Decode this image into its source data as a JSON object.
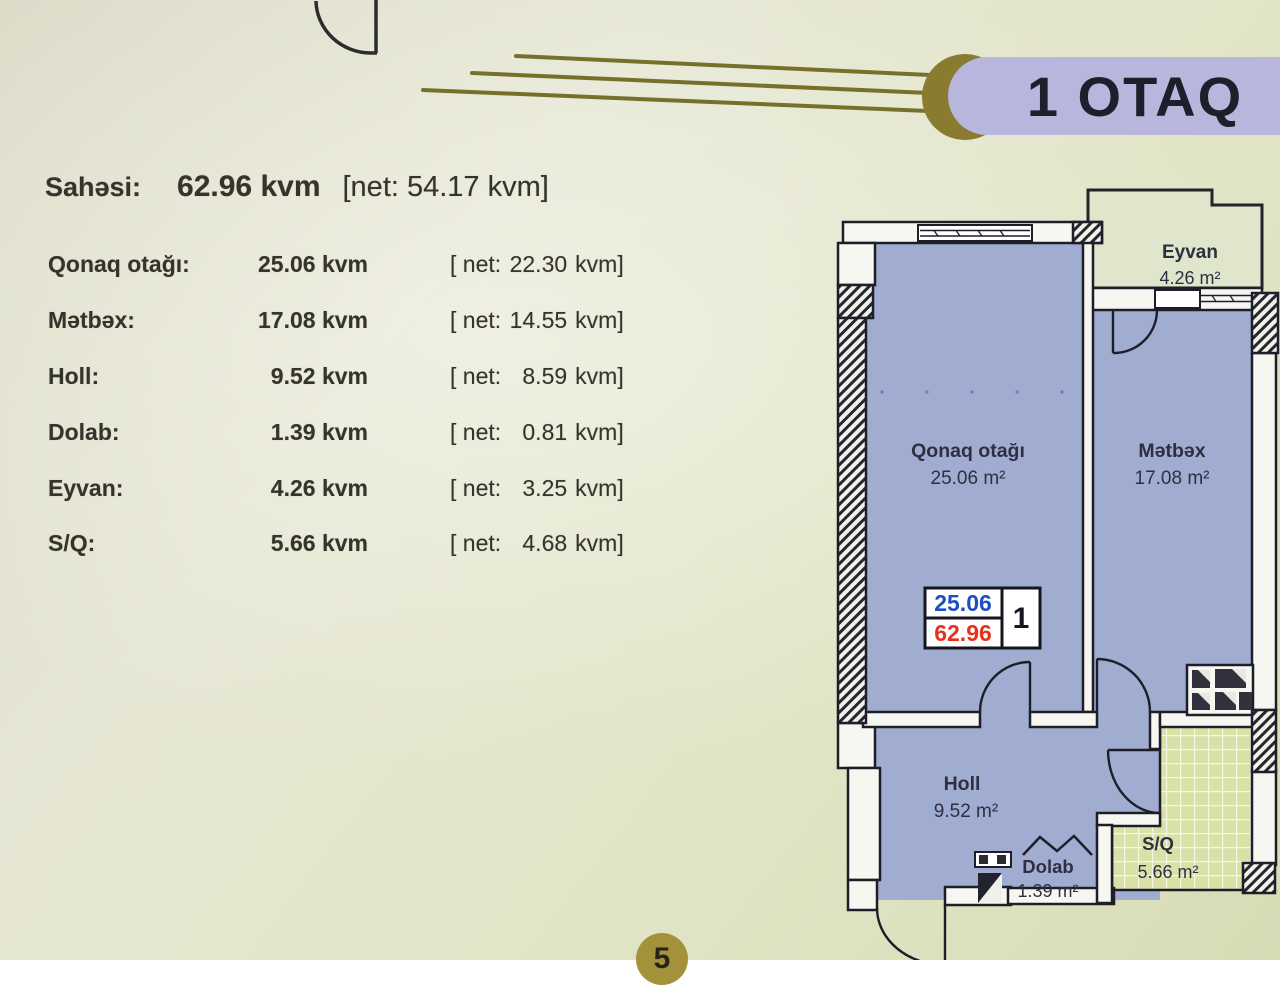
{
  "header": {
    "pill_label": "1 OTAQ"
  },
  "summary": {
    "label": "Sahəsi:",
    "total_value": "62.96 kvm",
    "net_value": "[net: 54.17 kvm]"
  },
  "area_table": {
    "rows": [
      {
        "label": "Qonaq otağı:",
        "area": "25.06 kvm",
        "net_prefix": "[ net:",
        "net_value": "22.30",
        "net_unit": "kvm]"
      },
      {
        "label": "Mətbəx:",
        "area": "17.08 kvm",
        "net_prefix": "[ net:",
        "net_value": "14.55",
        "net_unit": "kvm]"
      },
      {
        "label": "Holl:",
        "area": "9.52 kvm",
        "net_prefix": "[ net:",
        "net_value": "8.59",
        "net_unit": "kvm]"
      },
      {
        "label": "Dolab:",
        "area": "1.39 kvm",
        "net_prefix": "[ net:",
        "net_value": "0.81",
        "net_unit": "kvm]"
      },
      {
        "label": "Eyvan:",
        "area": "4.26 kvm",
        "net_prefix": "[ net:",
        "net_value": "3.25",
        "net_unit": "kvm]"
      },
      {
        "label": "S/Q:",
        "area": "5.66 kvm",
        "net_prefix": "[ net:",
        "net_value": "4.68",
        "net_unit": "kvm]"
      }
    ]
  },
  "floor_plan": {
    "rooms": {
      "eyvan": {
        "name": "Eyvan",
        "area": "4.26 m²"
      },
      "qonaq": {
        "name": "Qonaq otağı",
        "area": "25.06 m²"
      },
      "metbex": {
        "name": "Mətbəx",
        "area": "17.08 m²"
      },
      "holl": {
        "name": "Holl",
        "area": "9.52 m²"
      },
      "dolab": {
        "name": "Dolab",
        "area": "1.39 m²"
      },
      "sq": {
        "name": "S/Q",
        "area": "5.66 m²"
      }
    },
    "unit_badge": {
      "room_area": "25.06",
      "total_area": "62.96",
      "unit_number": "1"
    }
  },
  "footer": {
    "page_number": "5"
  },
  "colors": {
    "room_fill": "#a1acd1",
    "balcony_fill": "#e0e6cb",
    "wet_area_tile": "#d9e1a6",
    "wall_line": "#1e1e28",
    "accent_gold": "#76702a",
    "pill_bg": "#b8b6dd",
    "badge_blue": "#1d4ec4",
    "badge_red": "#e8301c"
  }
}
